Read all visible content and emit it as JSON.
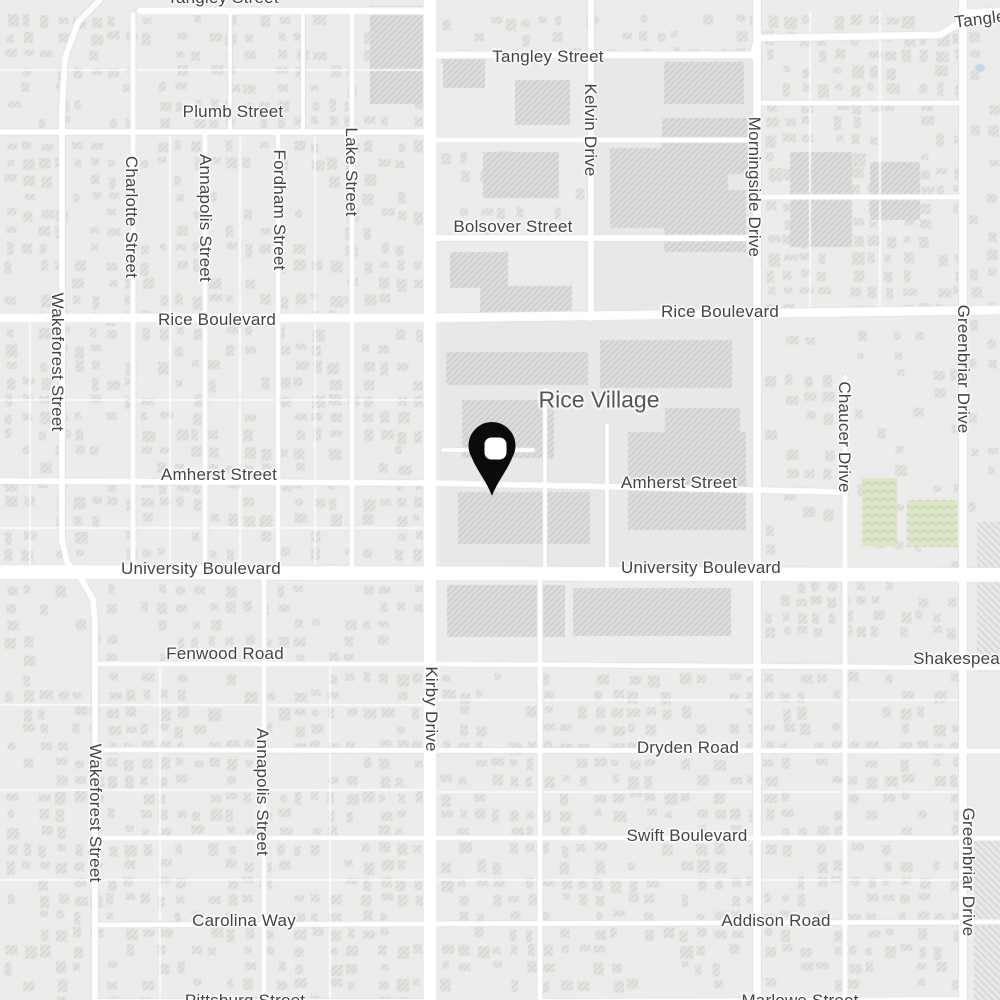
{
  "map": {
    "place_labels": [
      {
        "text": "Rice Village",
        "x": 599,
        "y": 400
      }
    ],
    "street_labels_horizontal": [
      {
        "text": "Tangley Street",
        "x": 223,
        "y": -2
      },
      {
        "text": "Tangley Street",
        "x": 548,
        "y": 57
      },
      {
        "text": "Tangley Street",
        "x": 1010,
        "y": 16,
        "tilt": -7
      },
      {
        "text": "Plumb Street",
        "x": 233,
        "y": 112
      },
      {
        "text": "Bolsover Street",
        "x": 513,
        "y": 227
      },
      {
        "text": "Rice Boulevard",
        "x": 217,
        "y": 320
      },
      {
        "text": "Rice Boulevard",
        "x": 720,
        "y": 312
      },
      {
        "text": "Amherst Street",
        "x": 219,
        "y": 475
      },
      {
        "text": "Amherst Street",
        "x": 679,
        "y": 483
      },
      {
        "text": "University Boulevard",
        "x": 201,
        "y": 569
      },
      {
        "text": "University Boulevard",
        "x": 701,
        "y": 568
      },
      {
        "text": "Fenwood Road",
        "x": 225,
        "y": 654
      },
      {
        "text": "Shakespeare Street",
        "x": 990,
        "y": 659
      },
      {
        "text": "Dryden Road",
        "x": 688,
        "y": 748
      },
      {
        "text": "Swift Boulevard",
        "x": 687,
        "y": 836
      },
      {
        "text": "Carolina Way",
        "x": 244,
        "y": 921
      },
      {
        "text": "Addison Road",
        "x": 776,
        "y": 921
      },
      {
        "text": "Pittsburg Street",
        "x": 245,
        "y": 1001
      },
      {
        "text": "Marlowe Street",
        "x": 800,
        "y": 1001
      }
    ],
    "street_labels_vertical": [
      {
        "text": "Wakeforest Street",
        "x": 57,
        "y": 362
      },
      {
        "text": "Charlotte Street",
        "x": 131,
        "y": 217
      },
      {
        "text": "Annapolis Street",
        "x": 205,
        "y": 218
      },
      {
        "text": "Fordham Street",
        "x": 279,
        "y": 210
      },
      {
        "text": "Lake Street",
        "x": 351,
        "y": 172
      },
      {
        "text": "Kelvin Drive",
        "x": 590,
        "y": 130
      },
      {
        "text": "Morningside Drive",
        "x": 754,
        "y": 187
      },
      {
        "text": "Greenbriar Drive",
        "x": 963,
        "y": 369
      },
      {
        "text": "Chaucer Drive",
        "x": 844,
        "y": 437
      },
      {
        "text": "Kirby Drive",
        "x": 431,
        "y": 709
      },
      {
        "text": "Wakeforest Street",
        "x": 95,
        "y": 813
      },
      {
        "text": "Annapolis Street",
        "x": 262,
        "y": 792
      },
      {
        "text": "Greenbriar Drive",
        "x": 968,
        "y": 872
      }
    ],
    "marker": {
      "type": "map-pin",
      "tip_x": 492,
      "tip_y": 497,
      "color": "#0b0b0c",
      "hole_color": "#ffffff"
    },
    "colors": {
      "background": "#edeceb",
      "block_tint": "#e9e8e6",
      "road": "#ffffff",
      "road_casing": "#dfdedc",
      "building": "#e4e3e1",
      "building_hatch": "#d0cfcd",
      "commercial": "#dfdedc",
      "commercial_hatch": "#c5c4c2",
      "park": "#dce6ca",
      "park_hatch": "#c3d5a6",
      "label_text": "#434446",
      "place_label_text": "#55565a",
      "pin": "#0b0b0c",
      "water": "#bdd9ec"
    }
  }
}
